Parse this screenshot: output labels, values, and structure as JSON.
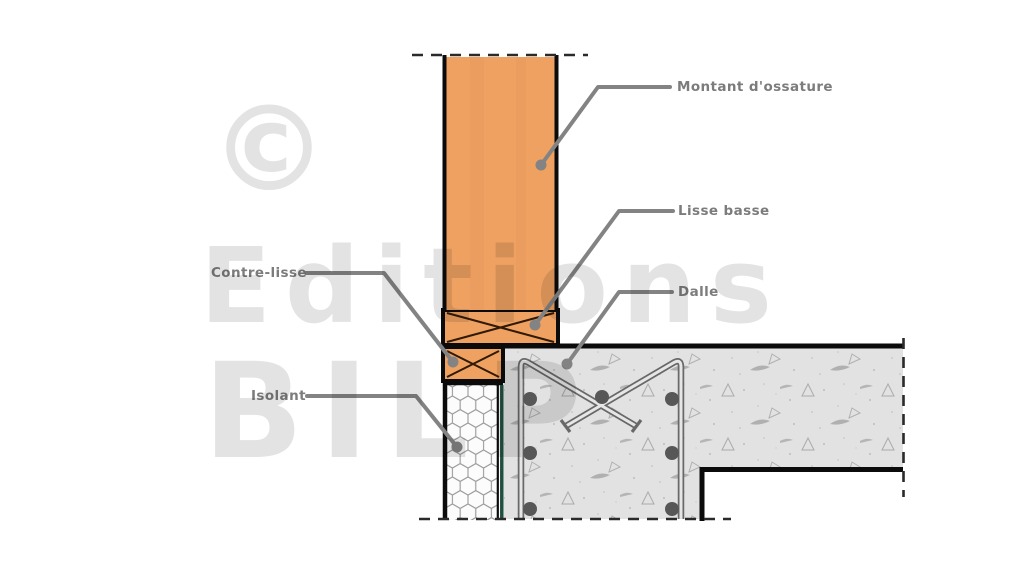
{
  "diagram": {
    "labels": {
      "montant": "Montant d'ossature",
      "lisse_basse": "Lisse basse",
      "contre_lisse": "Contre-lisse",
      "dalle": "Dalle",
      "isolant": "Isolant"
    },
    "watermark": {
      "copyright": "©",
      "line1": "Editions",
      "line2": "BILP"
    },
    "colors": {
      "wood": "#EFA161",
      "wood_cross_line": "#301A05",
      "outline_black": "#0B0B0B",
      "concrete_base": "#E2E2E2",
      "concrete_marks": "#ABABAB",
      "insulation_fill": "#FCFCFC",
      "insulation_hex_line": "#9C9C9C",
      "insulation_membrane_green": "#215040",
      "rebar_gray": "#686868",
      "leader_gray": "#838383",
      "label_text": "#7C7C7C",
      "watermark_gray": "#E3E3E3"
    }
  }
}
